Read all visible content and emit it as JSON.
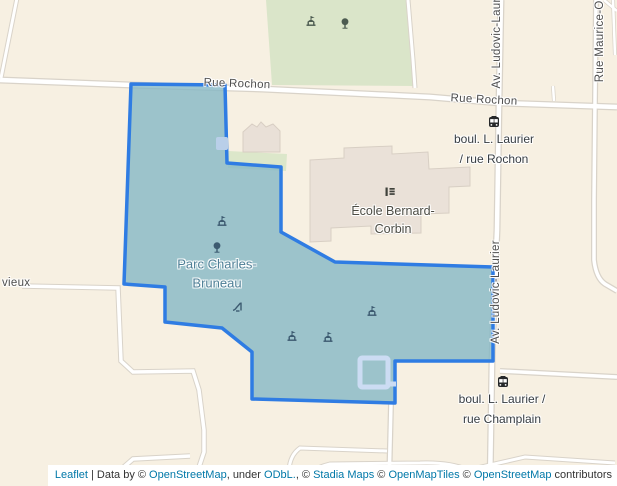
{
  "map": {
    "streets": {
      "rue_rochon_1": "Rue Rochon",
      "rue_rochon_2": "Rue Rochon",
      "av_ludovic_top": "Av. Ludovic-Lauri",
      "av_ludovic_mid": "Av. Ludovic-Laurier",
      "rue_maurice": "Rue Maurice-Ou",
      "vieux": "vieux"
    },
    "pois": {
      "park": {
        "line1": "Parc Charles-",
        "line2": "Bruneau"
      },
      "school": {
        "line1": "École Bernard-",
        "line2": "Corbin"
      }
    },
    "bus_stops": [
      {
        "line1": "boul. L. Laurier",
        "line2": "/ rue Rochon"
      },
      {
        "line1": "boul. L. Laurier /",
        "line2": "rue Champlain"
      }
    ],
    "icons": [
      "shelter-icon",
      "tree-icon",
      "slide-icon",
      "school-icon",
      "bus-icon"
    ],
    "colors": {
      "background": "#f7f0e2",
      "green_area": "#dae5c9",
      "road_fill": "#ffffff",
      "road_casing": "#d9d3c9",
      "building": "#eae1d8",
      "selection_fill": "#9cc3cb",
      "selection_stroke": "#2f7ce3",
      "pool_outline": "#ccdcf3",
      "street_label": "#4e4e4e",
      "park_label": "#4e7f96",
      "link": "#0078a8"
    }
  },
  "attribution": {
    "parts": [
      {
        "text": "Leaflet",
        "link": true
      },
      {
        "text": " | Data by © ",
        "link": false
      },
      {
        "text": "OpenStreetMap",
        "link": true
      },
      {
        "text": ", under ",
        "link": false
      },
      {
        "text": "ODbL.",
        "link": true
      },
      {
        "text": ", © ",
        "link": false
      },
      {
        "text": "Stadia Maps",
        "link": true
      },
      {
        "text": " © ",
        "link": false
      },
      {
        "text": "OpenMapTiles",
        "link": true
      },
      {
        "text": " © ",
        "link": false
      },
      {
        "text": "OpenStreetMap",
        "link": true
      },
      {
        "text": " contributors",
        "link": false
      }
    ]
  }
}
